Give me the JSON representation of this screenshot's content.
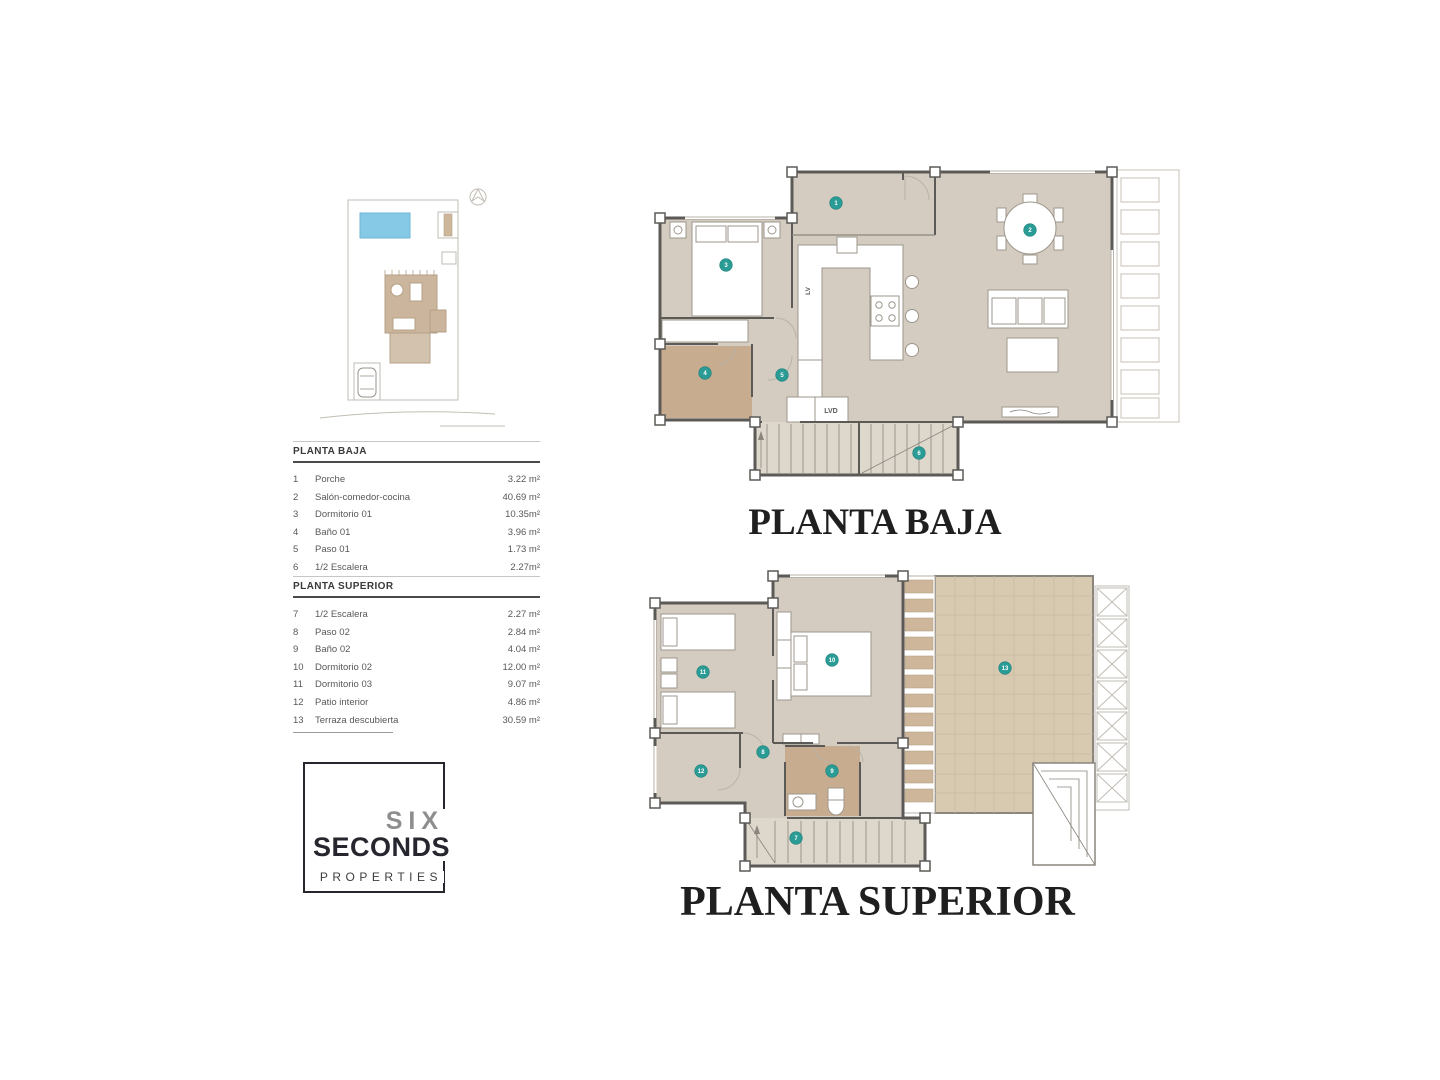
{
  "document": {
    "type": "floor-plan-sheet"
  },
  "colors": {
    "marker_teal": "#2a9b95",
    "pool_blue": "#85c9e6",
    "floor_taupe": "#d4ccc0",
    "bath_tan": "#c8ac8f",
    "terrace_tan": "#d8cab1",
    "wall_gray": "#5c5a57",
    "logo_dark": "#26262e",
    "logo_gray": "#8e8e8e"
  },
  "tables": {
    "planta_baja": {
      "title": "PLANTA BAJA",
      "rows": [
        {
          "num": "1",
          "label": "Porche",
          "area": "3.22 m²"
        },
        {
          "num": "2",
          "label": "Salón-comedor-cocina",
          "area": "40.69 m²"
        },
        {
          "num": "3",
          "label": "Dormitorio 01",
          "area": "10.35m²"
        },
        {
          "num": "4",
          "label": "Baño 01",
          "area": "3.96 m²"
        },
        {
          "num": "5",
          "label": "Paso 01",
          "area": "1.73 m²"
        },
        {
          "num": "6",
          "label": "1/2 Escalera",
          "area": "2.27m²"
        }
      ]
    },
    "planta_superior": {
      "title": "PLANTA SUPERIOR",
      "rows": [
        {
          "num": "7",
          "label": "1/2 Escalera",
          "area": "2.27 m²"
        },
        {
          "num": "8",
          "label": "Paso 02",
          "area": "2.84 m²"
        },
        {
          "num": "9",
          "label": "Baño 02",
          "area": "4.04 m²"
        },
        {
          "num": "10",
          "label": "Dormitorio 02",
          "area": "12.00 m²"
        },
        {
          "num": "11",
          "label": "Dormitorio 03",
          "area": "9.07 m²"
        },
        {
          "num": "12",
          "label": "Patio interior",
          "area": "4.86 m²"
        },
        {
          "num": "13",
          "label": "Terraza descubierta",
          "area": "30.59 m²"
        }
      ]
    }
  },
  "logo": {
    "six": "SIX",
    "seconds": "SECONDS",
    "properties": "PROPERTIES"
  },
  "plans": {
    "ground": {
      "title": "PLANTA BAJA",
      "labels": {
        "lv": "LV",
        "lvd": "LVD"
      },
      "markers": [
        {
          "n": "1",
          "x": 196,
          "y": 43
        },
        {
          "n": "2",
          "x": 390,
          "y": 70
        },
        {
          "n": "3",
          "x": 86,
          "y": 105
        },
        {
          "n": "4",
          "x": 65,
          "y": 213
        },
        {
          "n": "5",
          "x": 142,
          "y": 215
        },
        {
          "n": "6",
          "x": 279,
          "y": 293
        }
      ]
    },
    "upper": {
      "title": "PLANTA SUPERIOR",
      "markers": [
        {
          "n": "7",
          "x": 171,
          "y": 270
        },
        {
          "n": "8",
          "x": 138,
          "y": 184
        },
        {
          "n": "9",
          "x": 207,
          "y": 203
        },
        {
          "n": "10",
          "x": 207,
          "y": 92
        },
        {
          "n": "11",
          "x": 78,
          "y": 104
        },
        {
          "n": "12",
          "x": 76,
          "y": 203
        },
        {
          "n": "13",
          "x": 380,
          "y": 100
        }
      ]
    }
  }
}
